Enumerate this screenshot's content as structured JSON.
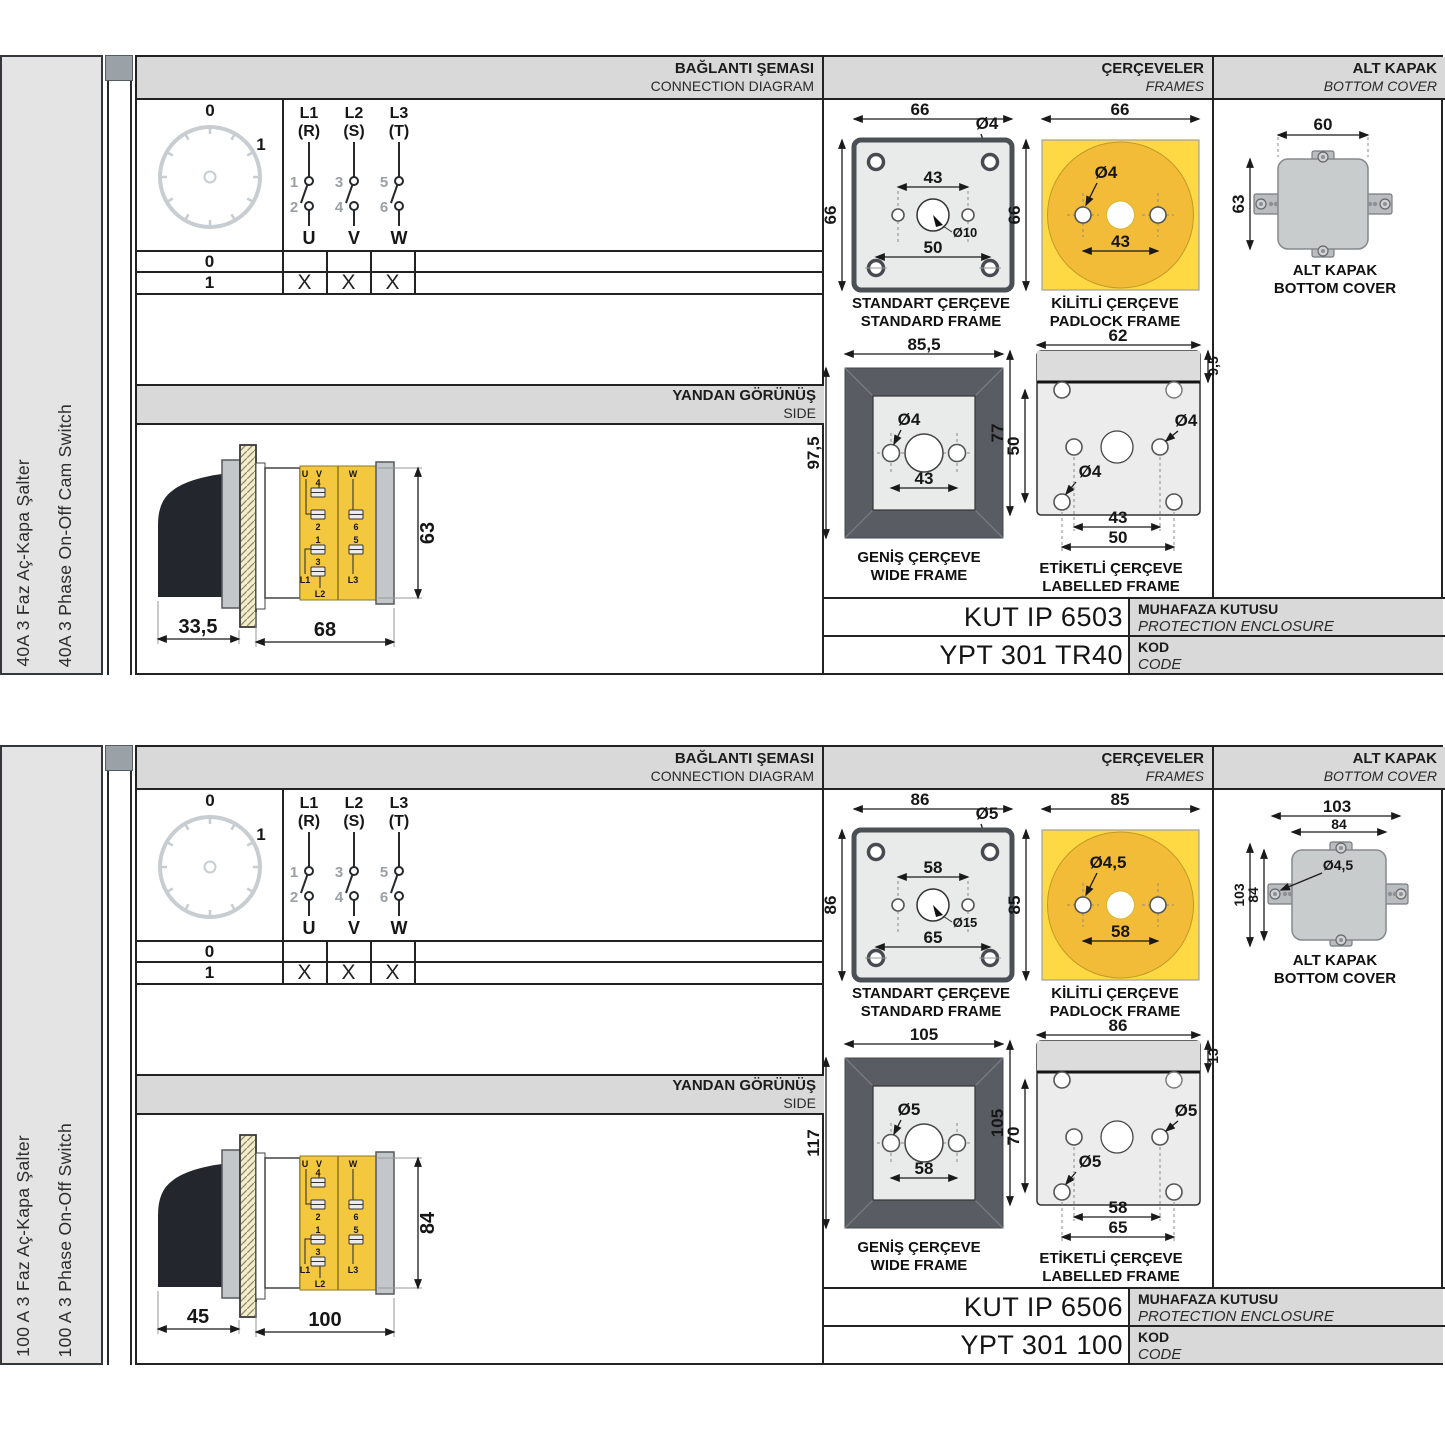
{
  "palette": {
    "header_bg": "#d9d9d9",
    "sidebar_bg": "#e4e4e4",
    "yellow": "#ffd944",
    "yellow_deep": "#f2bc39",
    "frame_dark": "#595d63",
    "cover_gray": "#c9cccd",
    "line": "#222222"
  },
  "common": {
    "header": {
      "connection_tr": "BAĞLANTI ŞEMASI",
      "connection_en": "CONNECTION DIAGRAM",
      "frames_tr": "ÇERÇEVELER",
      "frames_en": "FRAMES",
      "bottom_tr": "ALT KAPAK",
      "bottom_en": "BOTTOM COVER"
    },
    "side_header": {
      "tr": "YANDAN GÖRÜNÜŞ",
      "en": "SIDE"
    },
    "dial": {
      "pos0": "0",
      "pos1": "1"
    },
    "phases": {
      "p1": {
        "line": "L1",
        "phase": "(R)",
        "top": "1",
        "bottom": "2",
        "out": "U"
      },
      "p2": {
        "line": "L2",
        "phase": "(S)",
        "top": "3",
        "bottom": "4",
        "out": "V"
      },
      "p3": {
        "line": "L3",
        "phase": "(T)",
        "top": "5",
        "bottom": "6",
        "out": "W"
      }
    },
    "state_table": {
      "row0": "0",
      "row1": "1",
      "x1": "X",
      "x2": "X",
      "x3": "X"
    },
    "captions": {
      "standard_tr": "STANDART ÇERÇEVE",
      "standard_en": "STANDARD FRAME",
      "padlock_tr": "KİLİTLİ ÇERÇEVE",
      "padlock_en": "PADLOCK FRAME",
      "wide_tr": "GENİŞ ÇERÇEVE",
      "wide_en": "WIDE FRAME",
      "labelled_tr": "ETİKETLİ ÇERÇEVE",
      "labelled_en": "LABELLED FRAME",
      "cover_tr": "ALT KAPAK",
      "cover_en": "BOTTOM COVER"
    },
    "code_labels": {
      "enclosure_tr": "MUHAFAZA KUTUSU",
      "enclosure_en": "PROTECTION ENCLOSURE",
      "code_tr": "KOD",
      "code_en": "CODE"
    },
    "side_terminals": {
      "u": "U",
      "v": "V",
      "w": "W",
      "t1": "1",
      "t2": "2",
      "t3": "3",
      "t4": "4",
      "t5": "5",
      "t6": "6",
      "l1": "L1",
      "l2": "L2",
      "l3": "L3"
    }
  },
  "block1": {
    "title_tr": "40A 3 Faz Aç-Kapa Şalter",
    "title_en": "40A 3 Phase On-Off Cam Switch",
    "side_view": {
      "depth": "33,5",
      "length": "68",
      "height": "63"
    },
    "standard_frame": {
      "width": "66",
      "height": "66",
      "corner_hole": "Ø4",
      "center_hole": "Ø10",
      "hole_span": "43",
      "lower_span": "50"
    },
    "padlock_frame": {
      "width": "66",
      "height": "66",
      "hole": "Ø4",
      "hole_span": "43"
    },
    "wide_frame": {
      "width": "85,5",
      "height": "97,5",
      "hole": "Ø4",
      "hole_span": "43"
    },
    "labelled_frame": {
      "width": "62",
      "label_strip": "9,5",
      "height": "77",
      "hole_row_span": "50",
      "hole_a": "Ø4",
      "hole_b": "Ø4",
      "span_inner": "43",
      "span_outer": "50"
    },
    "bottom_cover": {
      "width": "60",
      "height": "63"
    },
    "enclosure_code": "KUT IP 6503",
    "product_code": "YPT 301 TR40"
  },
  "block2": {
    "title_tr": "100 A 3 Faz Aç-Kapa Şalter",
    "title_en": "100 A 3 Phase On-Off Switch",
    "side_view": {
      "depth": "45",
      "length": "100",
      "height": "84"
    },
    "standard_frame": {
      "width": "86",
      "height": "86",
      "corner_hole": "Ø5",
      "center_hole": "Ø15",
      "hole_span": "58",
      "lower_span": "65"
    },
    "padlock_frame": {
      "width": "85",
      "height": "85",
      "hole": "Ø4,5",
      "hole_span": "58"
    },
    "wide_frame": {
      "width": "105",
      "height": "117",
      "hole": "Ø5",
      "hole_span": "58"
    },
    "labelled_frame": {
      "width": "86",
      "label_strip": "13",
      "height": "105",
      "hole_row_span": "70",
      "hole_a": "Ø5",
      "hole_b": "Ø5",
      "span_inner": "58",
      "span_outer": "65"
    },
    "bottom_cover": {
      "width_outer": "103",
      "width_inner": "84",
      "height_outer": "103",
      "height_inner": "84",
      "hole": "Ø4,5"
    },
    "enclosure_code": "KUT IP 6506",
    "product_code": "YPT 301 100"
  }
}
